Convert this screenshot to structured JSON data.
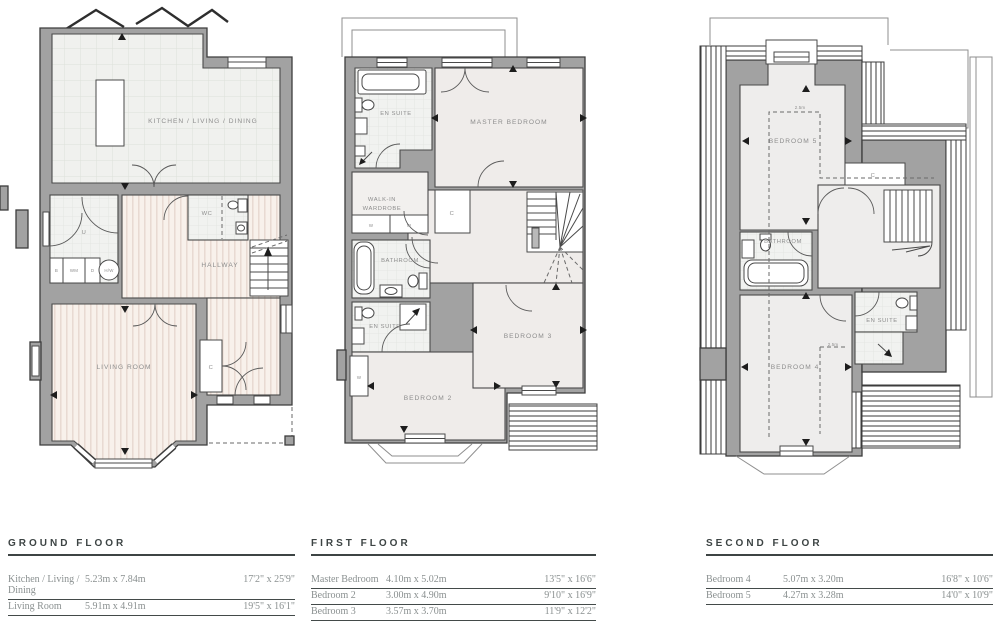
{
  "plans": {
    "ground": {
      "labels": {
        "kitchen": "KITCHEN / LIVING / DINING",
        "living": "LIVING ROOM",
        "hallway": "HALLWAY",
        "wc": "WC",
        "utility": "U",
        "closet": "C",
        "appliance_b": "B",
        "appliance_wm": "WM",
        "appliance_d": "D",
        "appliance_hw": "H/W"
      }
    },
    "first": {
      "labels": {
        "master": "MASTER BEDROOM",
        "ensuite_top": "EN SUITE",
        "walkin_1": "WALK-IN",
        "walkin_2": "WARDROBE",
        "closet": "C",
        "wardrobe_left": "W",
        "wardrobe_right": "W",
        "bathroom": "BATHROOM",
        "ensuite_mid": "EN SUITE",
        "wardrobe_bed2": "W",
        "bedroom2": "BEDROOM 2",
        "bedroom3": "BEDROOM 3"
      }
    },
    "second": {
      "labels": {
        "bedroom5": "BEDROOM 5",
        "bedroom4": "BEDROOM 4",
        "bathroom": "BATHROOM",
        "ensuite": "EN SUITE",
        "closet": "C",
        "headroom_top": "2.5m",
        "headroom_mid": "2.5m"
      }
    }
  },
  "tables": [
    {
      "title": "GROUND FLOOR",
      "rows": [
        {
          "name": "Kitchen / Living / Dining",
          "metric": "5.23m x 7.84m",
          "imperial": "17'2\" x 25'9\""
        },
        {
          "name": "Living Room",
          "metric": "5.91m x 4.91m",
          "imperial": "19'5\" x 16'1\""
        }
      ]
    },
    {
      "title": "FIRST FLOOR",
      "rows": [
        {
          "name": "Master Bedroom",
          "metric": "4.10m x 5.02m",
          "imperial": "13'5\" x 16'6\""
        },
        {
          "name": "Bedroom 2",
          "metric": "3.00m x 4.90m",
          "imperial": "9'10\" x 16'9\""
        },
        {
          "name": "Bedroom 3",
          "metric": "3.57m x 3.70m",
          "imperial": "11'9\" x 12'2\""
        }
      ]
    },
    {
      "title": "SECOND FLOOR",
      "rows": [
        {
          "name": "Bedroom 4",
          "metric": "5.07m x 3.20m",
          "imperial": "16'8\" x 10'6\""
        },
        {
          "name": "Bedroom 5",
          "metric": "4.27m x 3.28m",
          "imperial": "14'0\" x 10'9\""
        }
      ]
    }
  ]
}
